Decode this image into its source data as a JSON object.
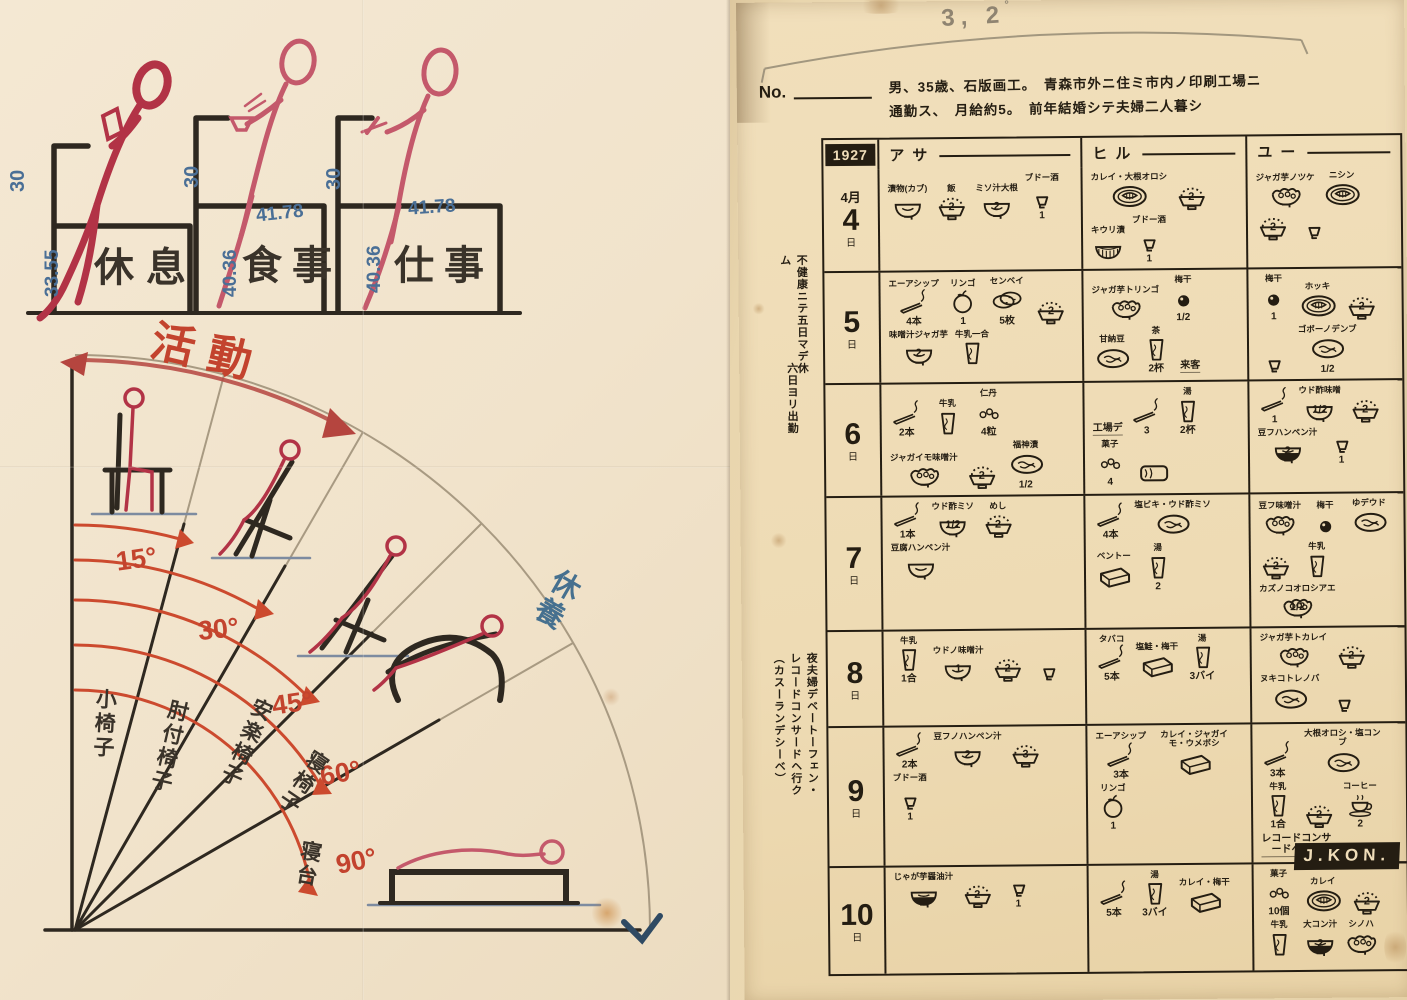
{
  "left_panel": {
    "chairs": [
      {
        "label": "休息",
        "back_no": "30",
        "front_no": "33.55",
        "top_no": ""
      },
      {
        "label": "食事",
        "back_no": "30",
        "front_no": "40.36",
        "top_no": "41.78"
      },
      {
        "label": "仕事",
        "back_no": "30",
        "front_no": "40.36",
        "top_no": "41.78"
      }
    ],
    "fan": {
      "activity_label": "活動",
      "rest_label": "休養",
      "angle_labels": [
        "15°",
        "30°",
        "45°",
        "60°",
        "90°"
      ],
      "chair_type_labels": [
        "小椅子",
        "肘付椅子",
        "安楽椅子",
        "寝椅子",
        "寝台"
      ]
    }
  },
  "right_panel": {
    "pencil_note": "3, 2",
    "pencil_degree": "°",
    "no_label": "No.",
    "desc_line1": "男、35歳、石版画工。　青森市外ニ住ミ市内ノ印刷工場ニ",
    "desc_line2": "通勤ス、　月給約5。　前年結婚シテ夫婦二人暮シ",
    "year": "1927",
    "columns": [
      "アサ",
      "ヒル",
      "ユー"
    ],
    "margin_notes": [
      "不健康ニテ五日マデ休ム",
      "六日ヨリ出勤",
      "夜夫婦デベートーフェン・レコードコンサードヘ行ク（カスーランデシーベ）"
    ],
    "signature": "J.KON.",
    "rows": [
      {
        "month": "4月",
        "day": "4",
        "suffix": "日",
        "h": 88,
        "asa": [
          {
            "icon": "bowl",
            "label": "漬物(カブ)"
          },
          {
            "icon": "rice",
            "qty": "2",
            "label": "飯"
          },
          {
            "icon": "bowl",
            "qty": "2",
            "label": "ミソ汁大根"
          },
          {
            "icon": "sake",
            "qty": "1",
            "label": "ブドー酒"
          }
        ],
        "hiru": [
          {
            "icon": "plate",
            "label": "カレイ・大根オロシ"
          },
          {
            "icon": "rice",
            "qty": "2"
          },
          {
            "icon": "basket",
            "label": "キウリ漬"
          },
          {
            "icon": "sake",
            "qty": "1",
            "label": "ブドー酒"
          }
        ],
        "yu": [
          {
            "icon": "fancybowl",
            "label": "ジャガ芋ノツケ"
          },
          {
            "icon": "plate",
            "label": "ニシン"
          },
          {
            "icon": "rice",
            "qty": "2"
          },
          {
            "icon": "sake"
          }
        ]
      },
      {
        "month": "",
        "day": "5",
        "suffix": "日",
        "h": 100,
        "asa": [
          {
            "icon": "cig",
            "qty": "4本",
            "label": "エーアシップ"
          },
          {
            "icon": "apple",
            "qty": "1",
            "label": "リンゴ"
          },
          {
            "icon": "senbei",
            "qty": "5枚",
            "label": "センベイ"
          },
          {
            "icon": "rice",
            "qty": "2"
          },
          {
            "icon": "bowl",
            "qty": "2",
            "label": "味噌汁ジャガ芋"
          },
          {
            "icon": "cup",
            "label": "牛乳一合"
          }
        ],
        "hiru": [
          {
            "icon": "fancybowl",
            "label": "ジャガ芋トリンゴ"
          },
          {
            "icon": "plum",
            "qty": "1/2",
            "label": "梅干"
          },
          {
            "icon": "platefood",
            "label": "甘納豆"
          },
          {
            "icon": "cup",
            "qty": "2杯",
            "label": "茶"
          },
          {
            "note": "来客"
          }
        ],
        "yu": [
          {
            "icon": "plum",
            "qty": "1",
            "label": "梅干"
          },
          {
            "icon": "plate",
            "label": "ホッキ"
          },
          {
            "icon": "rice",
            "qty": "2"
          },
          {
            "icon": "sake"
          },
          {
            "icon": "platefood",
            "qty": "1/2",
            "label": "ゴボーノデンブ"
          }
        ]
      },
      {
        "month": "",
        "day": "6",
        "suffix": "日",
        "h": 100,
        "asa": [
          {
            "icon": "cig",
            "qty": "2本"
          },
          {
            "icon": "cup",
            "label": "牛乳"
          },
          {
            "icon": "candy",
            "qty": "4粒",
            "label": "仁丹"
          },
          {
            "icon": "fancybowl",
            "label": "ジャガイモ味噌汁"
          },
          {
            "icon": "rice",
            "qty": "2"
          },
          {
            "icon": "platefood",
            "qty": "1/2",
            "label": "福神漬"
          }
        ],
        "hiru": [
          {
            "note": "工場デ"
          },
          {
            "icon": "cig",
            "qty": "3"
          },
          {
            "icon": "cup",
            "qty": "2杯",
            "label": "湯"
          },
          {
            "icon": "candy",
            "qty": "4",
            "label": "菓子"
          },
          {
            "icon": "loaf"
          }
        ],
        "yu": [
          {
            "icon": "cig",
            "qty": "1"
          },
          {
            "icon": "bowl",
            "qty": "1/2",
            "label": "ウド酢味噌"
          },
          {
            "icon": "rice",
            "qty": "2"
          },
          {
            "icon": "darkbowl",
            "qty": "2",
            "label": "豆フハンペン汁"
          },
          {
            "icon": "sake",
            "qty": "1"
          }
        ]
      },
      {
        "month": "",
        "day": "7",
        "suffix": "日",
        "h": 98,
        "asa": [
          {
            "icon": "cig",
            "qty": "1本"
          },
          {
            "icon": "bowl",
            "qty": "1/2",
            "label": "ウド酢ミソ"
          },
          {
            "icon": "rice",
            "qty": "2",
            "label": "めし"
          },
          {
            "icon": "bowl",
            "label": "豆腐ハンペン汁"
          }
        ],
        "hiru": [
          {
            "icon": "cig",
            "qty": "4本"
          },
          {
            "icon": "platefood",
            "label": "塩ビキ・ウド酢ミソ"
          },
          {
            "icon": "bento",
            "label": "ベントー"
          },
          {
            "icon": "cup",
            "qty": "2",
            "label": "湯"
          }
        ],
        "yu": [
          {
            "icon": "fancybowl",
            "label": "豆フ味噌汁"
          },
          {
            "icon": "plum",
            "label": "梅干"
          },
          {
            "icon": "platefood",
            "label": "ゆデウド"
          },
          {
            "icon": "rice",
            "qty": "2"
          },
          {
            "icon": "cup",
            "label": "牛乳"
          },
          {
            "icon": "fancybowl",
            "qty": "1/2",
            "label": "カズノコオロシアエ"
          }
        ]
      },
      {
        "month": "",
        "day": "8",
        "suffix": "日",
        "h": 96,
        "asa": [
          {
            "icon": "cup",
            "qty": "1合",
            "label": "牛乳"
          },
          {
            "icon": "bowl",
            "qty": "1",
            "label": "ウドノ味噌汁"
          },
          {
            "icon": "rice",
            "qty": "2"
          },
          {
            "icon": "sake"
          }
        ],
        "hiru": [
          {
            "icon": "cig",
            "qty": "5本",
            "label": "タバコ"
          },
          {
            "icon": "bento",
            "label": "塩鮭・梅干"
          },
          {
            "icon": "cup",
            "qty": "3バイ",
            "label": "湯"
          }
        ],
        "yu": [
          {
            "icon": "fancybowl",
            "label": "ジャガ芋トカレイ"
          },
          {
            "icon": "rice",
            "qty": "2"
          },
          {
            "icon": "platefood",
            "label": "ヌキコトレノバ"
          },
          {
            "icon": "sake"
          }
        ]
      },
      {
        "month": "",
        "day": "9",
        "suffix": "日",
        "h": 100,
        "asa": [
          {
            "icon": "cig",
            "qty": "2本"
          },
          {
            "icon": "bowl",
            "qty": "2",
            "label": "豆フノハンペン汁"
          },
          {
            "icon": "rice",
            "qty": "3"
          },
          {
            "icon": "sake",
            "qty": "1",
            "label": "ブドー酒"
          }
        ],
        "hiru": [
          {
            "icon": "cig",
            "qty": "3本",
            "label": "エーアシップ"
          },
          {
            "icon": "bento",
            "label": "カレイ・ジャガイモ・ウメボシ"
          },
          {
            "icon": "apple",
            "qty": "1",
            "label": "リンゴ"
          }
        ],
        "yu": [
          {
            "icon": "cig",
            "qty": "3本"
          },
          {
            "icon": "platefood",
            "label": "大根オロシ・塩コンブ"
          },
          {
            "icon": "cup",
            "qty": "1合",
            "label": "牛乳"
          },
          {
            "icon": "rice",
            "qty": "2"
          },
          {
            "icon": "coffee",
            "qty": "2",
            "label": "コーヒー"
          },
          {
            "note": "レコードコンサードヘ行ク"
          }
        ]
      },
      {
        "month": "",
        "day": "10",
        "suffix": "日",
        "h": 108,
        "asa": [
          {
            "icon": "darkbowl",
            "label": "じゃが芋醤油汁"
          },
          {
            "icon": "rice",
            "qty": "2"
          },
          {
            "icon": "sake",
            "qty": "1"
          }
        ],
        "hiru": [
          {
            "icon": "cig",
            "qty": "5本"
          },
          {
            "icon": "cup",
            "qty": "3バイ",
            "label": "湯"
          },
          {
            "icon": "bento",
            "label": "カレイ・梅干"
          }
        ],
        "yu": [
          {
            "icon": "candy",
            "qty": "10個",
            "label": "菓子"
          },
          {
            "icon": "plate",
            "label": "カレイ"
          },
          {
            "icon": "rice",
            "qty": "2"
          },
          {
            "icon": "cup",
            "label": "牛乳"
          },
          {
            "icon": "darkbowl",
            "qty": "2",
            "label": "大コン汁"
          },
          {
            "icon": "fancybowl",
            "label": "シノハ"
          }
        ]
      }
    ]
  }
}
